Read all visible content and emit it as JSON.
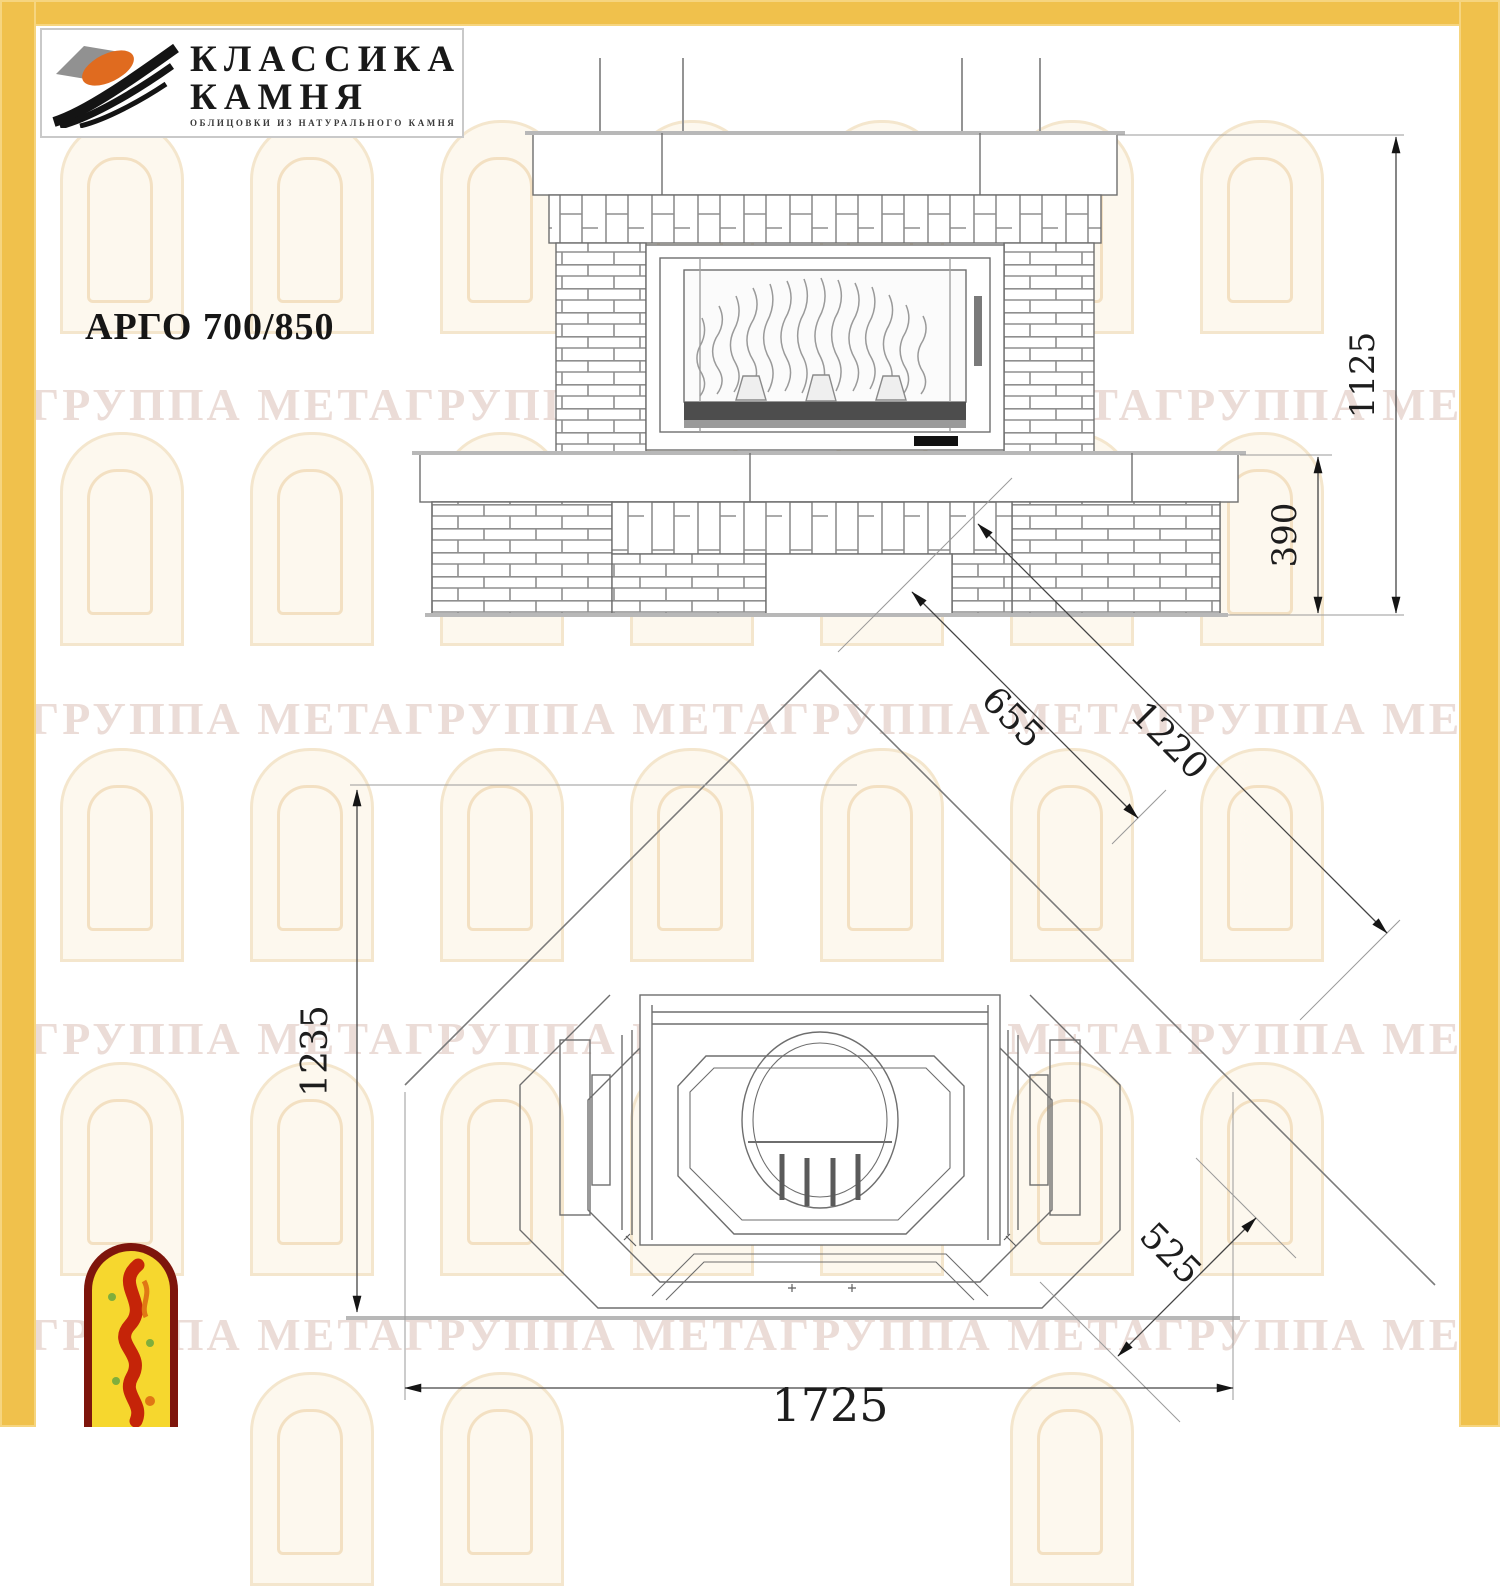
{
  "logo": {
    "line1": "КЛАССИКА",
    "line2": "КАМНЯ",
    "subtitle": "ОБЛИЦОВКИ ИЗ НАТУРАЛЬНОГО КАМНЯ"
  },
  "title": "АРГО 700/850",
  "watermark": {
    "text": "ГРУППА МЕТАГРУППА МЕТАГРУППА МЕТАГРУППА МЕТАГРУППА МЕТА"
  },
  "drawing": {
    "front_view": {
      "dims": {
        "total_height": "1125",
        "base_height": "390"
      }
    },
    "plan_view": {
      "dims": {
        "side_depth": "1235",
        "diag_inner": "655",
        "diag_outer": "1220",
        "corner_offset": "525",
        "total_width": "1725"
      }
    }
  },
  "colors": {
    "frame_yellow": "#f0c14c",
    "line_gray": "#6e6e6e",
    "accent_orange": "#e06b1f",
    "emblem_red": "#7e150c",
    "emblem_yellow": "#f6d72e"
  }
}
